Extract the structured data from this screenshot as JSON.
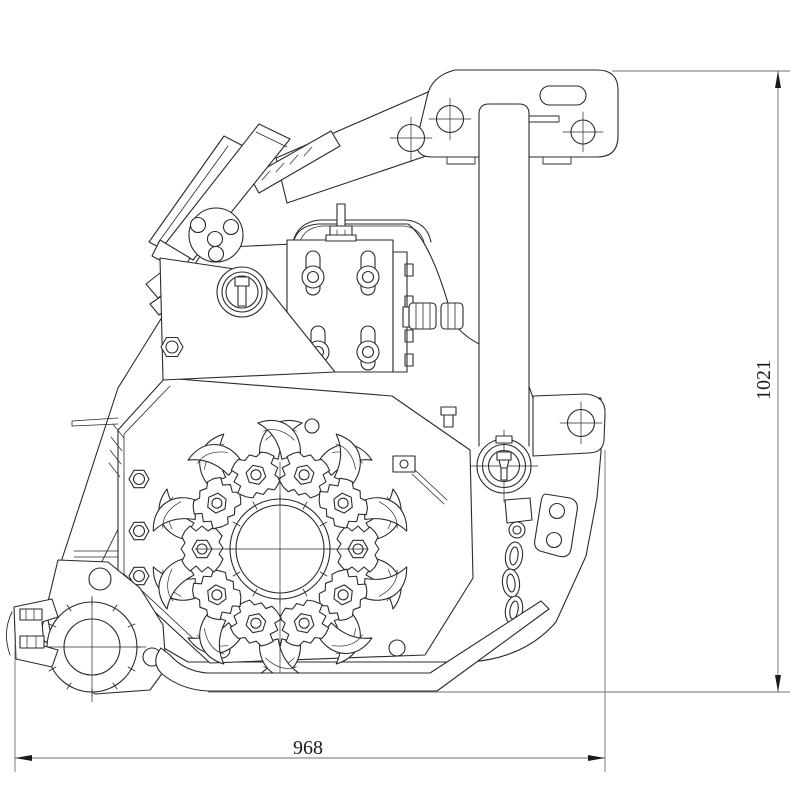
{
  "drawing": {
    "type": "technical-line-drawing",
    "subject": "implement-side-view-with-flail-rotor",
    "dim_width": "968",
    "dim_height": "1021",
    "line_color": "#2b2b2b",
    "dim_color": "#6f6f6f",
    "text_color": "#1a1a1a",
    "background_color": "#ffffff"
  }
}
